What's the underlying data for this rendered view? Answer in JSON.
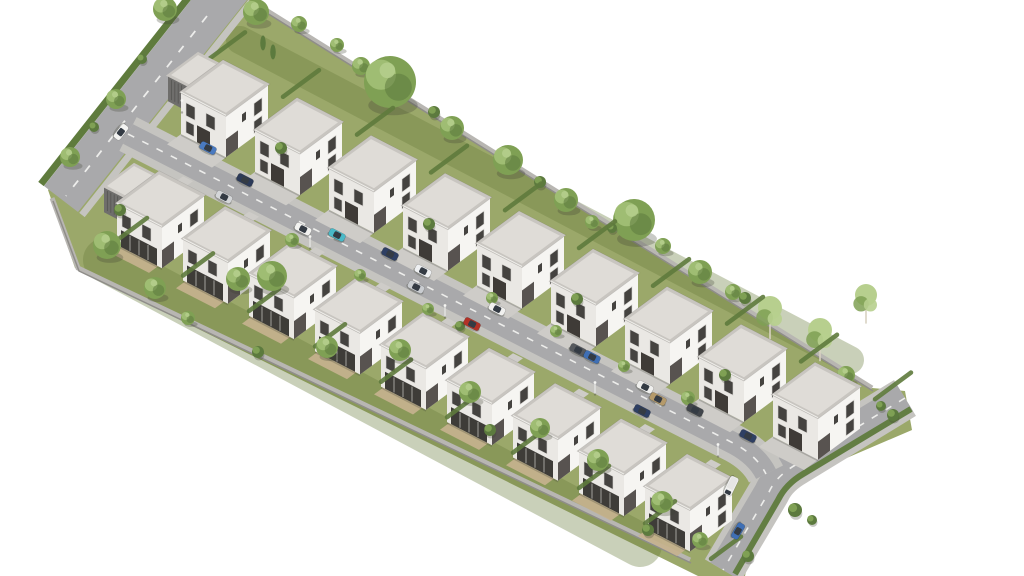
{
  "scene": {
    "width": 1024,
    "height": 576,
    "background": "#ffffff"
  },
  "iso": {
    "u": [
      1,
      0.515
    ],
    "v": [
      -1,
      0.74
    ]
  },
  "palette": {
    "grass": "#9ba86a",
    "gardenTint": "rgba(104,124,62,0.36)",
    "road": "#a9a9ab",
    "sidewalk": "#c5c4c0",
    "driveway": "#ceccc8",
    "dash": "#ededeb",
    "hedge": "#5f7b3d",
    "wallTop": "#b8b6b2",
    "wallShadow": "#8f8d89",
    "roofParapet": "#c8c5c0",
    "roofTop": "#dfdcd7",
    "roofLine": "#efeeea",
    "wallSW": "#eae8e4",
    "wallSE": "#f6f5f2",
    "window": "#454340",
    "frame": "#d8d6d2",
    "door": "#3f3b37",
    "recess": "rgba(52,48,44,0.82)",
    "garage": "#6f6e6c",
    "garageLine": "#575654",
    "patio": "#c6b28e",
    "treeMid": "#7fa054",
    "treeLight": "#a3c077",
    "treeDark": "#5c7a3e",
    "birchLight": "#b7cf8e",
    "trunk": "#8a7a60",
    "birchTrunk": "#d8d2c2",
    "carGlass": "#343b44",
    "shadow": "rgba(60,65,50,0.28)",
    "lamp": "#e9e9e7"
  },
  "ground": {
    "outline": [
      [
        191,
        0
      ],
      [
        253,
        0
      ],
      [
        872,
        388
      ],
      [
        905,
        391
      ],
      [
        912,
        430
      ],
      [
        800,
        478
      ],
      [
        760,
        508
      ],
      [
        745,
        576
      ],
      [
        698,
        576
      ],
      [
        75,
        268
      ],
      [
        48,
        190
      ]
    ]
  },
  "gardenBands": [
    {
      "from": [
        240,
        40
      ],
      "to": [
        850,
        360
      ],
      "width": 28
    },
    {
      "from": [
        105,
        260
      ],
      "to": [
        640,
        545
      ],
      "width": 44
    }
  ],
  "roads": {
    "nw": {
      "outline": [
        [
          191,
          0
        ],
        [
          247,
          0
        ],
        [
          78,
          212
        ],
        [
          44,
          186
        ]
      ],
      "dash": [
        [
          207,
          16
        ],
        [
          66,
          196
        ]
      ],
      "outerHedge": [
        [
          188,
          -2
        ],
        [
          41,
          184
        ]
      ],
      "innerWalk": [
        [
          251,
          2
        ],
        [
          82,
          215
        ]
      ]
    },
    "street": {
      "path": "M128,134 L735,444 Q757,456 766,474",
      "width": 22,
      "walkWidth": 38
    },
    "right": {
      "path": "M905,398 L797,464 Q776,476 769,492 L723,570",
      "width": 30,
      "walkWidth": 42,
      "hedgePath": "M911,409 L803,474 Q786,484 778,500 L735,574"
    }
  },
  "walls": {
    "ne": [
      [
        253,
        2
      ],
      [
        872,
        388
      ]
    ],
    "sw": [
      [
        52,
        198
      ],
      [
        78,
        268
      ],
      [
        690,
        560
      ]
    ]
  },
  "rows": {
    "top": {
      "count": 9,
      "origin": [
        223,
        61
      ],
      "step": [
        74,
        37.8
      ],
      "type": "front",
      "garageFirst": true
    },
    "bottom": {
      "count": 9,
      "origin": [
        159,
        172
      ],
      "step": [
        66,
        35.4
      ],
      "type": "garden",
      "garageFirst": true
    }
  },
  "houseDims": {
    "u": 45,
    "v": 42,
    "h": 42
  },
  "garageDims": {
    "u": 21,
    "v": 30,
    "h": 26
  },
  "driveLen": 14,
  "hedgeRows": {
    "top": {
      "count": 10,
      "base": [
        209,
        59
      ],
      "step": [
        74,
        37.8
      ],
      "dir": -1,
      "len": 36
    },
    "bottom": {
      "count": 10,
      "base": [
        147,
        218
      ],
      "step": [
        66,
        35.4
      ],
      "dir": 1,
      "len": 30
    }
  },
  "trees": {
    "back": [
      [
        256,
        12,
        13,
        "r"
      ],
      [
        299,
        24,
        8,
        "r"
      ],
      [
        337,
        45,
        7,
        "r"
      ],
      [
        361,
        66,
        9,
        "r"
      ],
      [
        390,
        82,
        26,
        "r"
      ],
      [
        452,
        128,
        12,
        "r"
      ],
      [
        508,
        160,
        15,
        "r"
      ],
      [
        566,
        200,
        12,
        "r"
      ],
      [
        592,
        222,
        7,
        "r"
      ],
      [
        634,
        220,
        21,
        "r"
      ],
      [
        663,
        246,
        8,
        "r"
      ],
      [
        700,
        272,
        12,
        "r"
      ],
      [
        733,
        292,
        8,
        "r"
      ],
      [
        770,
        308,
        12,
        "b"
      ],
      [
        820,
        330,
        12,
        "b"
      ],
      [
        866,
        295,
        11,
        "b"
      ],
      [
        846,
        375,
        9,
        "r"
      ],
      [
        165,
        9,
        12,
        "r"
      ],
      [
        116,
        99,
        10,
        "r"
      ],
      [
        70,
        157,
        10,
        "r"
      ],
      [
        94,
        127,
        5,
        "s"
      ],
      [
        142,
        59,
        5,
        "s"
      ],
      [
        263,
        43,
        5,
        "c"
      ],
      [
        273,
        52,
        5,
        "c"
      ],
      [
        434,
        112,
        6,
        "s"
      ],
      [
        540,
        182,
        6,
        "s"
      ],
      [
        612,
        228,
        5,
        "s"
      ],
      [
        745,
        298,
        6,
        "s"
      ]
    ],
    "front": [
      [
        107,
        245,
        14,
        "r"
      ],
      [
        155,
        288,
        11,
        "r"
      ],
      [
        238,
        279,
        12,
        "r"
      ],
      [
        272,
        276,
        15,
        "r"
      ],
      [
        327,
        347,
        11,
        "r"
      ],
      [
        400,
        350,
        11,
        "r"
      ],
      [
        470,
        392,
        11,
        "r"
      ],
      [
        540,
        428,
        10,
        "r"
      ],
      [
        598,
        460,
        11,
        "r"
      ],
      [
        662,
        502,
        11,
        "r"
      ],
      [
        700,
        540,
        8,
        "r"
      ],
      [
        292,
        240,
        7,
        "r"
      ],
      [
        360,
        275,
        6,
        "r"
      ],
      [
        428,
        309,
        6,
        "r"
      ],
      [
        460,
        326,
        5,
        "s"
      ],
      [
        492,
        298,
        6,
        "r"
      ],
      [
        556,
        331,
        6,
        "r"
      ],
      [
        624,
        366,
        6,
        "r"
      ],
      [
        688,
        398,
        7,
        "r"
      ],
      [
        281,
        148,
        6,
        "s"
      ],
      [
        429,
        224,
        6,
        "s"
      ],
      [
        577,
        299,
        6,
        "s"
      ],
      [
        725,
        375,
        6,
        "s"
      ],
      [
        893,
        415,
        6,
        "s"
      ],
      [
        881,
        406,
        5,
        "s"
      ],
      [
        795,
        510,
        7,
        "s"
      ],
      [
        812,
        520,
        5,
        "s"
      ],
      [
        748,
        556,
        6,
        "s"
      ],
      [
        120,
        210,
        6,
        "s"
      ],
      [
        188,
        318,
        7,
        "r"
      ],
      [
        258,
        352,
        6,
        "s"
      ],
      [
        490,
        430,
        6,
        "s"
      ],
      [
        648,
        530,
        6,
        "s"
      ]
    ]
  },
  "cars": [
    [
      121,
      132,
      "#f3f3f1",
      128
    ],
    [
      208,
      148,
      "#4a7ac0",
      27
    ],
    [
      245,
      180,
      "#2c3a58",
      27
    ],
    [
      224,
      197,
      "#d4d6d8",
      27
    ],
    [
      303,
      229,
      "#f2f2f0",
      27
    ],
    [
      337,
      235,
      "#49b9c8",
      27
    ],
    [
      390,
      254,
      "#2e3f63",
      27
    ],
    [
      423,
      271,
      "#eef0f2",
      27
    ],
    [
      416,
      287,
      "#c9ccd0",
      27
    ],
    [
      472,
      324,
      "#b23127",
      27
    ],
    [
      497,
      309,
      "#f1f1ef",
      27
    ],
    [
      578,
      350,
      "#56595e",
      27
    ],
    [
      592,
      357,
      "#3f6fb5",
      27
    ],
    [
      645,
      387,
      "#f0f0ee",
      27
    ],
    [
      658,
      399,
      "#b59a6a",
      27
    ],
    [
      695,
      410,
      "#41454b",
      27
    ],
    [
      642,
      411,
      "#2e3f63",
      27
    ],
    [
      748,
      436,
      "#2e3f63",
      27
    ],
    [
      738,
      531,
      "#3f6fb5",
      120
    ]
  ],
  "van": [
    731,
    486,
    "#f1f1ef",
    116
  ],
  "lamps": [
    [
      182,
      112
    ],
    [
      310,
      248
    ],
    [
      445,
      317
    ],
    [
      595,
      394
    ],
    [
      718,
      456
    ]
  ]
}
